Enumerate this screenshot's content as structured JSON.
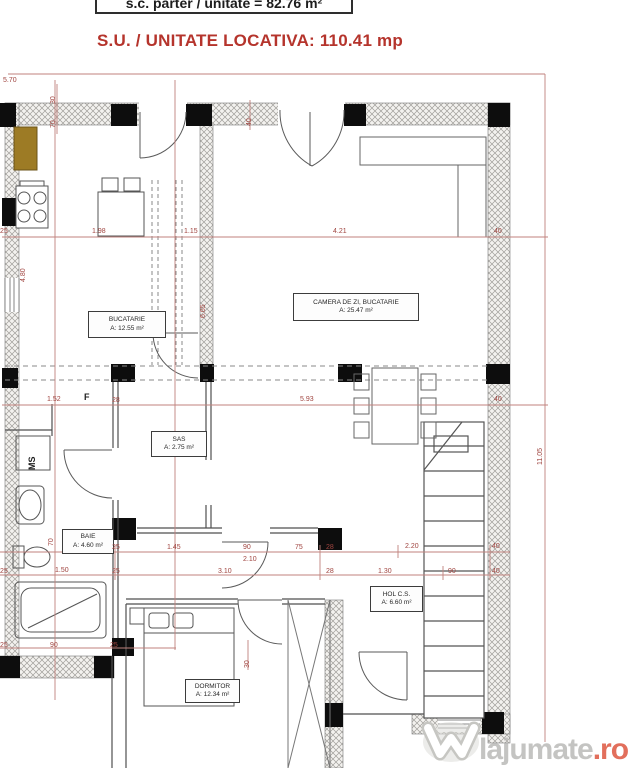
{
  "header": {
    "plan_info": "s.c. parter / unitate = 82.76 m²",
    "title": "S.U. / UNITATE LOCATIVA: 110.41 mp"
  },
  "rooms": [
    {
      "id": "bucatarie",
      "name": "BUCATARIE",
      "area": "A: 12.55 m²",
      "x": 88,
      "y": 311,
      "w": 78,
      "h": 27
    },
    {
      "id": "camera-de-zi",
      "name": "CAMERA DE ZI, BUCATARIE",
      "area": "A: 25.47 m²",
      "x": 293,
      "y": 293,
      "w": 126,
      "h": 28
    },
    {
      "id": "sas",
      "name": "SAS",
      "area": "A: 2.75 m²",
      "x": 151,
      "y": 431,
      "w": 56,
      "h": 26
    },
    {
      "id": "baie",
      "name": "BAIE",
      "area": "A: 4.60 m²",
      "x": 62,
      "y": 529,
      "w": 52,
      "h": 25
    },
    {
      "id": "hol",
      "name": "HOL C.S.",
      "area": "A: 6.60 m²",
      "x": 370,
      "y": 586,
      "w": 53,
      "h": 26
    },
    {
      "id": "dormitor",
      "name": "DORMITOR",
      "area": "A: 12.34 m²",
      "x": 185,
      "y": 679,
      "w": 55,
      "h": 24
    }
  ],
  "dimensions": [
    {
      "t": "5.70",
      "x": 3,
      "y": 77
    },
    {
      "t": "30",
      "x": 50,
      "y": 104,
      "rot": 1
    },
    {
      "t": "70",
      "x": 50,
      "y": 128,
      "rot": 1
    },
    {
      "t": "40",
      "x": 246,
      "y": 126,
      "rot": 1
    },
    {
      "t": "25",
      "x": 0,
      "y": 228
    },
    {
      "t": "1.98",
      "x": 92,
      "y": 228
    },
    {
      "t": "1.15",
      "x": 184,
      "y": 228
    },
    {
      "t": "4.21",
      "x": 333,
      "y": 228
    },
    {
      "t": "40",
      "x": 494,
      "y": 228
    },
    {
      "t": "4.80",
      "x": 20,
      "y": 282,
      "rot": 1
    },
    {
      "t": "6.65",
      "x": 200,
      "y": 318,
      "rot": 1
    },
    {
      "t": "1.52",
      "x": 47,
      "y": 396
    },
    {
      "t": "28",
      "x": 112,
      "y": 397
    },
    {
      "t": "5.93",
      "x": 300,
      "y": 396
    },
    {
      "t": "40",
      "x": 494,
      "y": 396
    },
    {
      "t": "11.05",
      "x": 537,
      "y": 465,
      "rot": 1
    },
    {
      "t": "70",
      "x": 48,
      "y": 546,
      "rot": 1
    },
    {
      "t": "25",
      "x": 112,
      "y": 544
    },
    {
      "t": "1.45",
      "x": 167,
      "y": 544
    },
    {
      "t": "90",
      "x": 243,
      "y": 544
    },
    {
      "t": "2.10",
      "x": 243,
      "y": 556
    },
    {
      "t": "75",
      "x": 295,
      "y": 544
    },
    {
      "t": "28",
      "x": 326,
      "y": 544
    },
    {
      "t": "2.20",
      "x": 405,
      "y": 543
    },
    {
      "t": "40",
      "x": 492,
      "y": 543
    },
    {
      "t": "25",
      "x": 0,
      "y": 568
    },
    {
      "t": "1.50",
      "x": 55,
      "y": 567
    },
    {
      "t": "25",
      "x": 112,
      "y": 568
    },
    {
      "t": "3.10",
      "x": 218,
      "y": 568
    },
    {
      "t": "28",
      "x": 326,
      "y": 568
    },
    {
      "t": "1.30",
      "x": 378,
      "y": 568
    },
    {
      "t": "90",
      "x": 448,
      "y": 568
    },
    {
      "t": "40",
      "x": 492,
      "y": 568
    },
    {
      "t": "25",
      "x": 0,
      "y": 642
    },
    {
      "t": "90",
      "x": 50,
      "y": 642
    },
    {
      "t": "25",
      "x": 110,
      "y": 642
    },
    {
      "t": "30",
      "x": 244,
      "y": 668,
      "rot": 1
    }
  ],
  "annotations": [
    {
      "t": "F",
      "x": 84,
      "y": 393,
      "rot": 0
    },
    {
      "t": "MS",
      "x": 28,
      "y": 470,
      "rot": 1
    }
  ],
  "watermark": {
    "brand": "lajumate",
    "tld": ".ro"
  },
  "colors": {
    "title_red": "#b5342c",
    "dimension_text": "#a04540",
    "dimension_line": "#c0827d",
    "wall_hatch": "#a09e9a",
    "plan_line": "#555555",
    "cabinet_brown": "#9d7b25"
  }
}
